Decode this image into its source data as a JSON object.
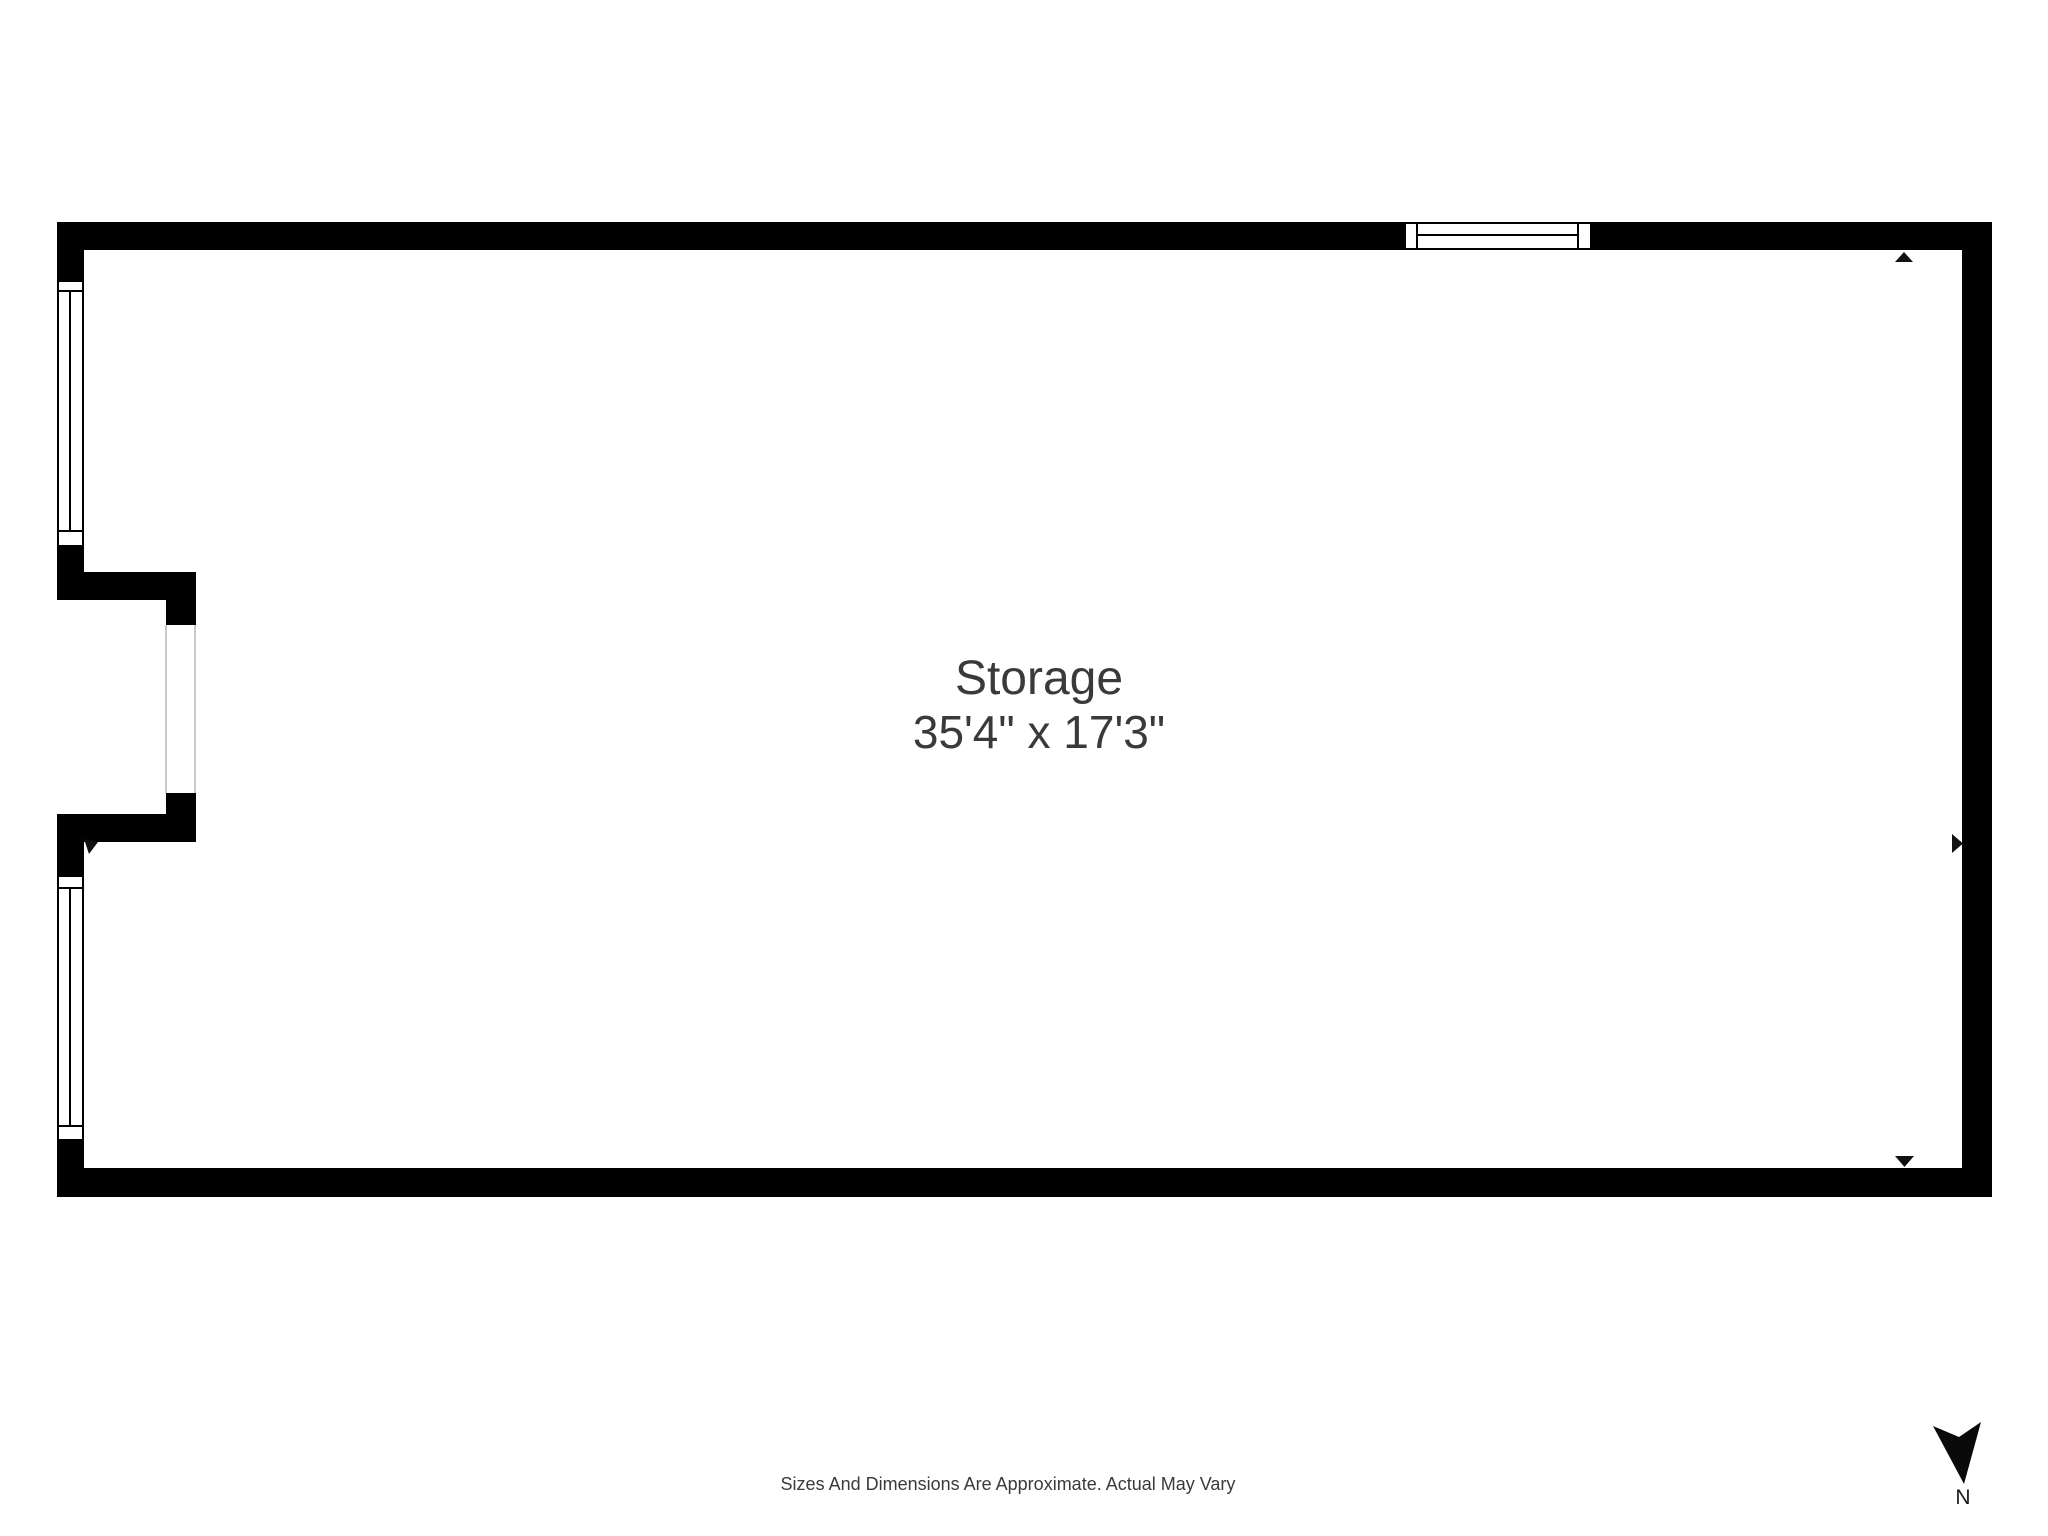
{
  "room": {
    "name": "Storage",
    "dimensions": "35'4\" x 17'3\""
  },
  "footer": {
    "disclaimer": "Sizes And Dimensions Are Approximate. Actual May Vary"
  },
  "compass": {
    "label": "N"
  },
  "colors": {
    "wall": "#000000",
    "background": "#ffffff",
    "text": "#3a3a3a",
    "opening_line": "#c9c9c9"
  }
}
